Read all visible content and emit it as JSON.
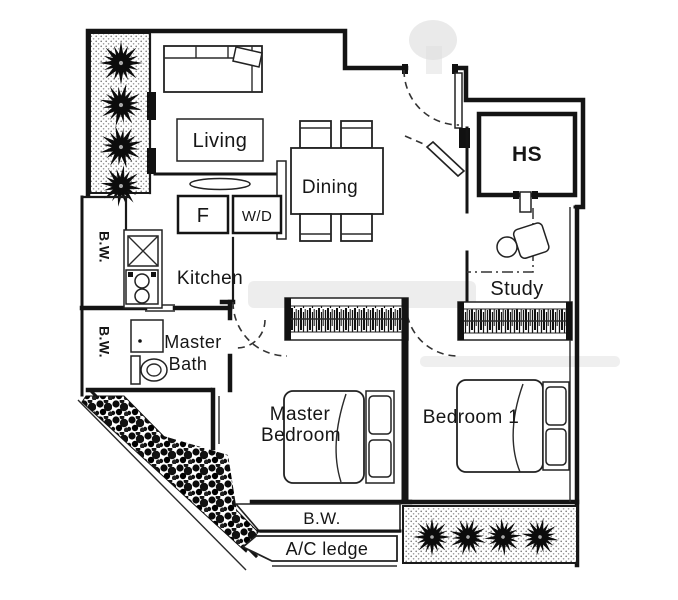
{
  "title": "Apartment floor plan",
  "colors": {
    "ink": "#161616",
    "paper": "#ffffff",
    "watermark": "#d9d9d9"
  },
  "labels": {
    "living": "Living",
    "dining": "Dining",
    "kitchen": "Kitchen",
    "fridge": "F",
    "washer_dryer": "W/D",
    "bw_left_upper": "B.W.",
    "bw_left_lower": "B.W.",
    "master_bath_1": "Master",
    "master_bath_2": "Bath",
    "master_bedroom_1": "Master",
    "master_bedroom_2": "Bedroom",
    "bedroom1": "Bedroom 1",
    "study": "Study",
    "shelter": "HS",
    "bw_bottom": "B.W.",
    "ac_ledge": "A/C ledge"
  }
}
